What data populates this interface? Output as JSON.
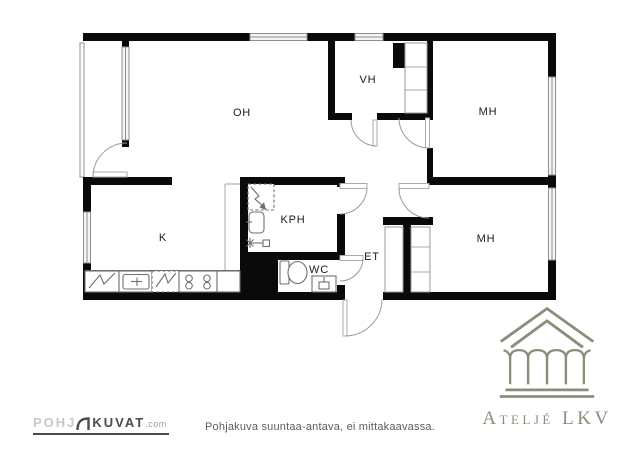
{
  "rooms": {
    "oh": {
      "label": "OH"
    },
    "vh": {
      "label": "VH"
    },
    "mh_top": {
      "label": "MH"
    },
    "mh_bottom": {
      "label": "MH"
    },
    "k": {
      "label": "K"
    },
    "kph": {
      "label": "KPH"
    },
    "et": {
      "label": "ET"
    },
    "wc": {
      "label": "WC"
    }
  },
  "footer": {
    "disclaimer": "Pohjakuva suuntaa-antava, ei mittakaavassa."
  },
  "logos": {
    "pohjakuvat": {
      "part1": "POHJ",
      "part2": "KUVAT",
      "suffix": ".com"
    },
    "atelje": {
      "name": "Ateljé LKV"
    }
  },
  "colors": {
    "wall": "#0a0a0a",
    "logo_accent": "#8b8e7b",
    "caption_text": "#5a5d60",
    "logo_dark": "#4a4a4a",
    "logo_light": "#c8c8c8"
  }
}
